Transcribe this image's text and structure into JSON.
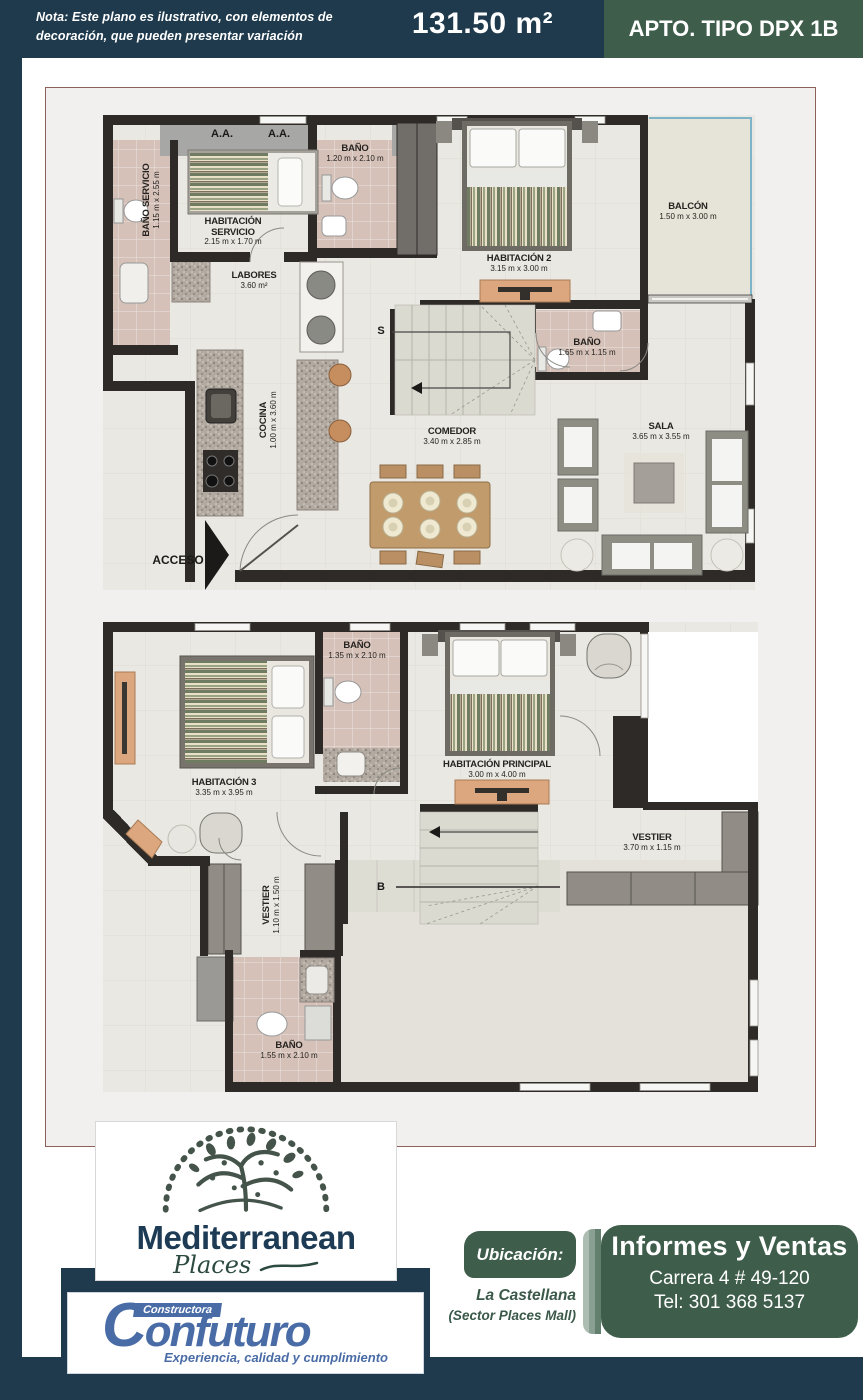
{
  "header": {
    "note_line1": "Nota: Este plano es ilustrativo, con elementos de",
    "note_line2": "decoración, que pueden presentar variación",
    "area": "131.50 m²",
    "apt_type": "APTO. TIPO DPX 1B"
  },
  "colors": {
    "navy": "#1f3a4d",
    "green": "#3e5d4a",
    "frame_border": "#8c6157",
    "wall": "#2d2a28",
    "bath_tile": "#d5c1b8",
    "floor": "#eae8e2",
    "confuturo_blue": "#4a6ca6",
    "balcony_window_blue": "#7fb4c8"
  },
  "plan_upper": {
    "ac_unit_1": "A.A.",
    "ac_unit_2": "A.A.",
    "stair_label": "S",
    "access_label": "ACCESO",
    "rooms": [
      {
        "name": "BAÑO SERVICIO",
        "dims": "1.15 m x 2.55 m"
      },
      {
        "name": "HABITACIÓN SERVICIO",
        "dims": "2.15 m x 1.70 m"
      },
      {
        "name": "BAÑO",
        "dims": "1.20 m x 2.10 m"
      },
      {
        "name": "HABITACIÓN 2",
        "dims": "3.15 m x 3.00 m"
      },
      {
        "name": "BALCÓN",
        "dims": "1.50 m x 3.00 m"
      },
      {
        "name": "LABORES",
        "dims": "3.60 m²"
      },
      {
        "name": "BAÑO",
        "dims": "1.65 m x 1.15 m"
      },
      {
        "name": "COCINA",
        "dims": "1.00 m x 3.60 m"
      },
      {
        "name": "COMEDOR",
        "dims": "3.40 m x 2.85 m"
      },
      {
        "name": "SALA",
        "dims": "3.65 m x 3.55 m"
      }
    ]
  },
  "plan_lower": {
    "stair_label": "B",
    "rooms": [
      {
        "name": "BAÑO",
        "dims": "1.35 m x 2.10 m"
      },
      {
        "name": "HABITACIÓN 3",
        "dims": "3.35 m x 3.95 m"
      },
      {
        "name": "HABITACIÓN PRINCIPAL",
        "dims": "3.00 m x 4.00 m"
      },
      {
        "name": "VESTIER",
        "dims": "3.70 m x 1.15 m"
      },
      {
        "name": "VESTIER",
        "dims": "1.10 m x 1.50 m"
      },
      {
        "name": "BAÑO",
        "dims": "1.55 m x 2.10 m"
      }
    ]
  },
  "footer": {
    "brand": {
      "name": "Mediterranean",
      "sub": "Places"
    },
    "constructor": {
      "badge": "Constructora",
      "name": "Confuturo",
      "tagline": "Experiencia, calidad y cumplimiento"
    },
    "location": {
      "label": "Ubicación:",
      "line1": "La Castellana",
      "line2": "(Sector Places Mall)"
    },
    "contact": {
      "title": "Informes y Ventas",
      "address": "Carrera 4 # 49-120",
      "phone": "Tel: 301 368 5137"
    }
  }
}
